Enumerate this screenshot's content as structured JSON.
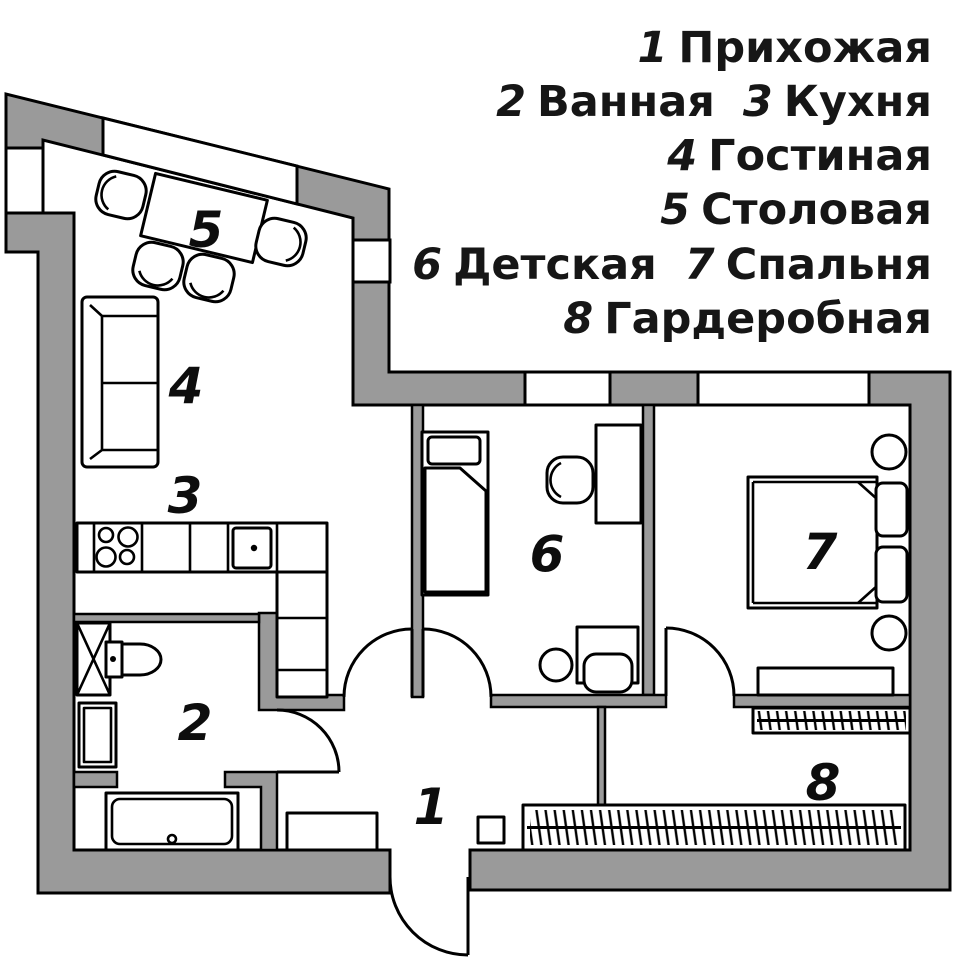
{
  "colors": {
    "wall_fill": "#9a9a9a",
    "outline": "#000000",
    "background": "#ffffff"
  },
  "legend": {
    "lines": [
      {
        "items": [
          {
            "num": "1",
            "name": "Прихожая"
          }
        ]
      },
      {
        "items": [
          {
            "num": "2",
            "name": "Ванная"
          },
          {
            "num": "3",
            "name": "Кухня"
          }
        ]
      },
      {
        "items": [
          {
            "num": "4",
            "name": "Гостиная"
          }
        ]
      },
      {
        "items": [
          {
            "num": "5",
            "name": "Столовая"
          }
        ]
      },
      {
        "items": [
          {
            "num": "6",
            "name": "Детская"
          },
          {
            "num": "7",
            "name": "Спальня"
          }
        ]
      },
      {
        "items": [
          {
            "num": "8",
            "name": "Гардеробная"
          }
        ]
      }
    ]
  },
  "rooms": [
    {
      "num": "1",
      "name": "Прихожая"
    },
    {
      "num": "2",
      "name": "Ванная"
    },
    {
      "num": "3",
      "name": "Кухня"
    },
    {
      "num": "4",
      "name": "Гостиная"
    },
    {
      "num": "5",
      "name": "Столовая"
    },
    {
      "num": "6",
      "name": "Детская"
    },
    {
      "num": "7",
      "name": "Спальня"
    },
    {
      "num": "8",
      "name": "Гардеробная"
    }
  ]
}
